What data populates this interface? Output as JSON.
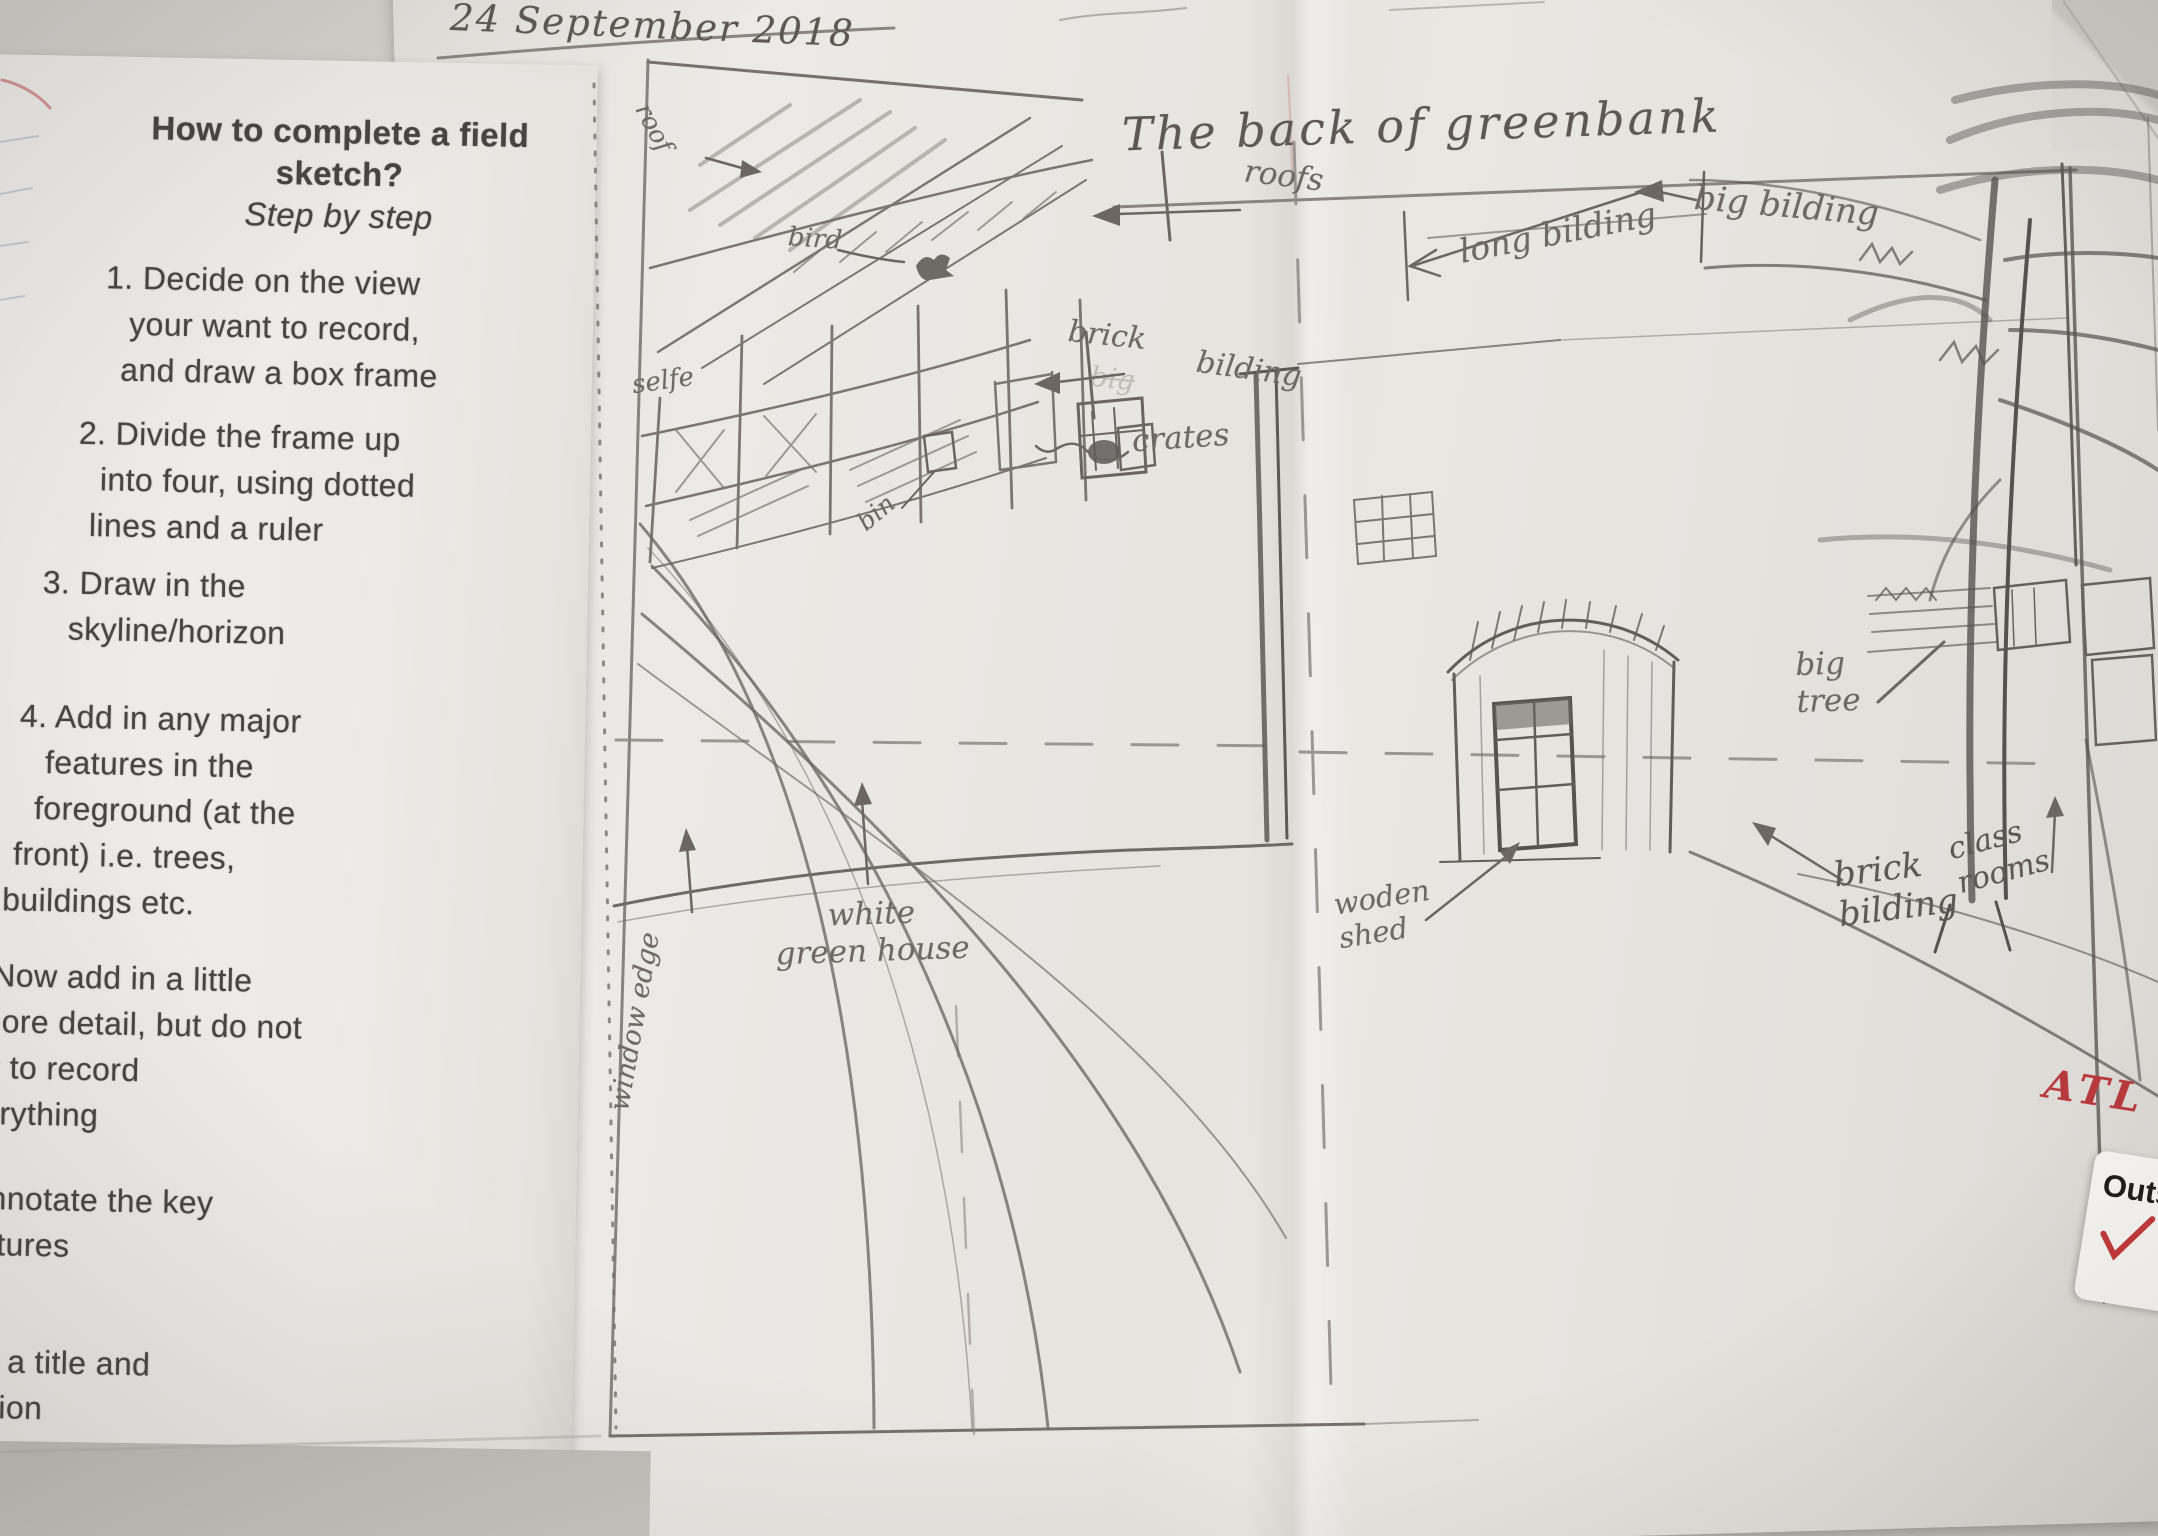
{
  "page": {
    "date": "24 September 2018",
    "atl_mark": "ATL",
    "sticker": {
      "label": "Outs"
    }
  },
  "instructions": {
    "heading": [
      "How to complete a field",
      "sketch?"
    ],
    "subheading": "Step by step",
    "steps": [
      {
        "lines": [
          "1. Decide on the view",
          "your want to record,",
          "and draw a box frame"
        ]
      },
      {
        "lines": [
          "2. Divide the frame up",
          "into four, using dotted",
          "lines and a ruler"
        ]
      },
      {
        "lines": [
          "3. Draw in the",
          "skyline/horizon"
        ]
      },
      {
        "lines": [
          "4. Add in any major",
          "features in the",
          "foreground (at the",
          "front) i.e. trees,",
          "buildings etc."
        ]
      },
      {
        "lines": [
          "5. Now add in a little",
          "more detail, but do not",
          "try to record",
          "everything"
        ]
      },
      {
        "lines": [
          "Annotate the key",
          "eatures"
        ]
      },
      {
        "lines": [
          "dd a title and",
          "cation"
        ]
      }
    ]
  },
  "sketch": {
    "title": "The back of greenbank",
    "annotations": {
      "roof": "roof",
      "bird": "bird",
      "shelf": "selfe",
      "bin": "bin",
      "brick_building_word1": "brick",
      "brick_building_word2": "bilding",
      "brick_building_ghost": "big",
      "crates": "crates",
      "roofs": "roofs",
      "long_building": "long bilding",
      "big_building": "big bilding",
      "big_tree": "big\ntree",
      "wooden_shed": "woden\nshed",
      "brick_building_lower": "brick\nbilding",
      "class_rooms": "class\nrooms",
      "white_greenhouse": "white\ngreen house",
      "window_edge": "window edge"
    }
  }
}
